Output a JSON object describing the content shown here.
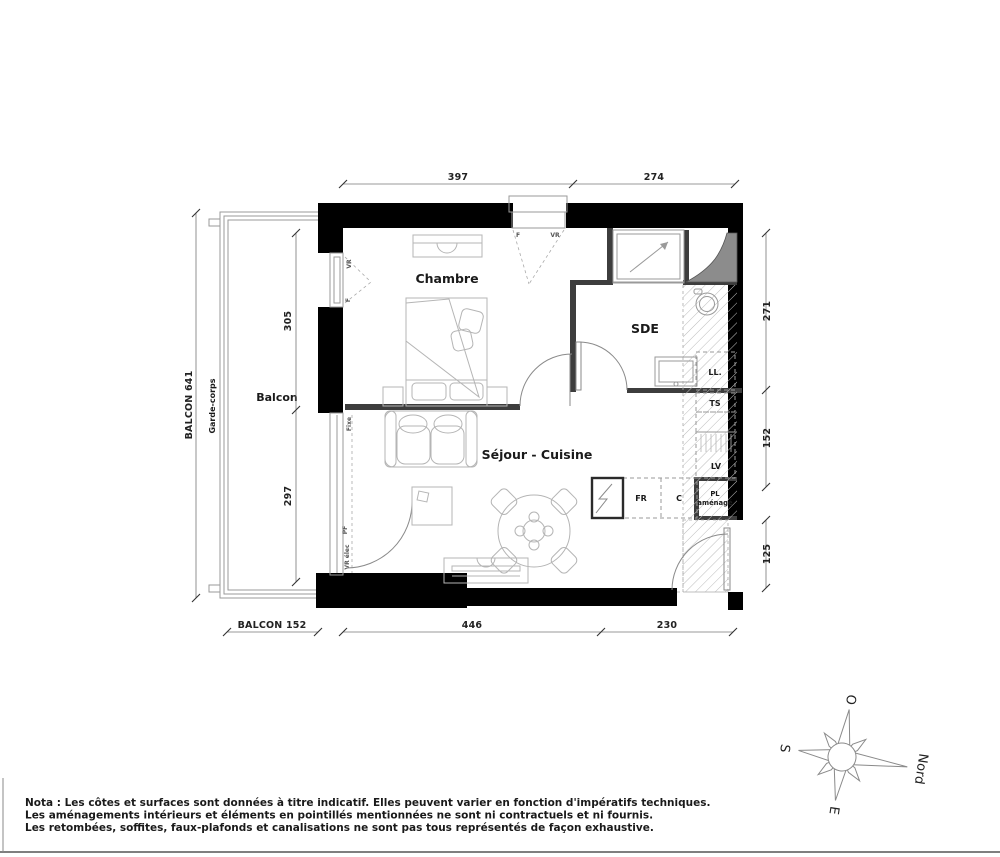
{
  "plan": {
    "rooms": {
      "chambre": "Chambre",
      "sde": "SDE",
      "sejour_cuisine": "Séjour - Cuisine",
      "balcon": "Balcon"
    },
    "fixtures": {
      "ll": "LL.",
      "ts": "TS",
      "lv": "LV",
      "fr": "FR",
      "c": "C",
      "pl_line1": "PL",
      "pl_line2": "aménagé"
    },
    "openings": {
      "f": "F",
      "vr": "VR",
      "fixe": "Fixe",
      "pf": "PF",
      "vr_elec": "VR élec"
    },
    "balcony": {
      "garde_corps": "Garde-corps"
    }
  },
  "dimensions": {
    "top": [
      "397",
      "274"
    ],
    "bottom": [
      "446",
      "230"
    ],
    "right": [
      "271",
      "152",
      "125"
    ],
    "balcony_total": "BALCON 641",
    "balcony_upper": "305",
    "balcony_lower": "297",
    "balcony_width": "BALCON 152"
  },
  "compass": {
    "north": "Nord",
    "south": "S",
    "east": "E",
    "west": "O"
  },
  "notes": {
    "line1": "Nota : Les côtes et surfaces sont données à titre indicatif. Elles peuvent varier en fonction d'impératifs techniques.",
    "line2": "Les aménagements intérieurs et éléments en pointillés mentionnées ne sont ni contractuels et ni fournis.",
    "line3": "Les retombées, soffites, faux-plafonds et canalisations ne sont pas tous représentés de façon exhaustive."
  },
  "colors": {
    "exterior_wall": "#000000",
    "interior_wall": "#3d3d3d",
    "duct_fill": "#8c8c8c",
    "furniture_stroke": "#b5b5b5",
    "hatch_stroke": "#bcbcbc"
  }
}
